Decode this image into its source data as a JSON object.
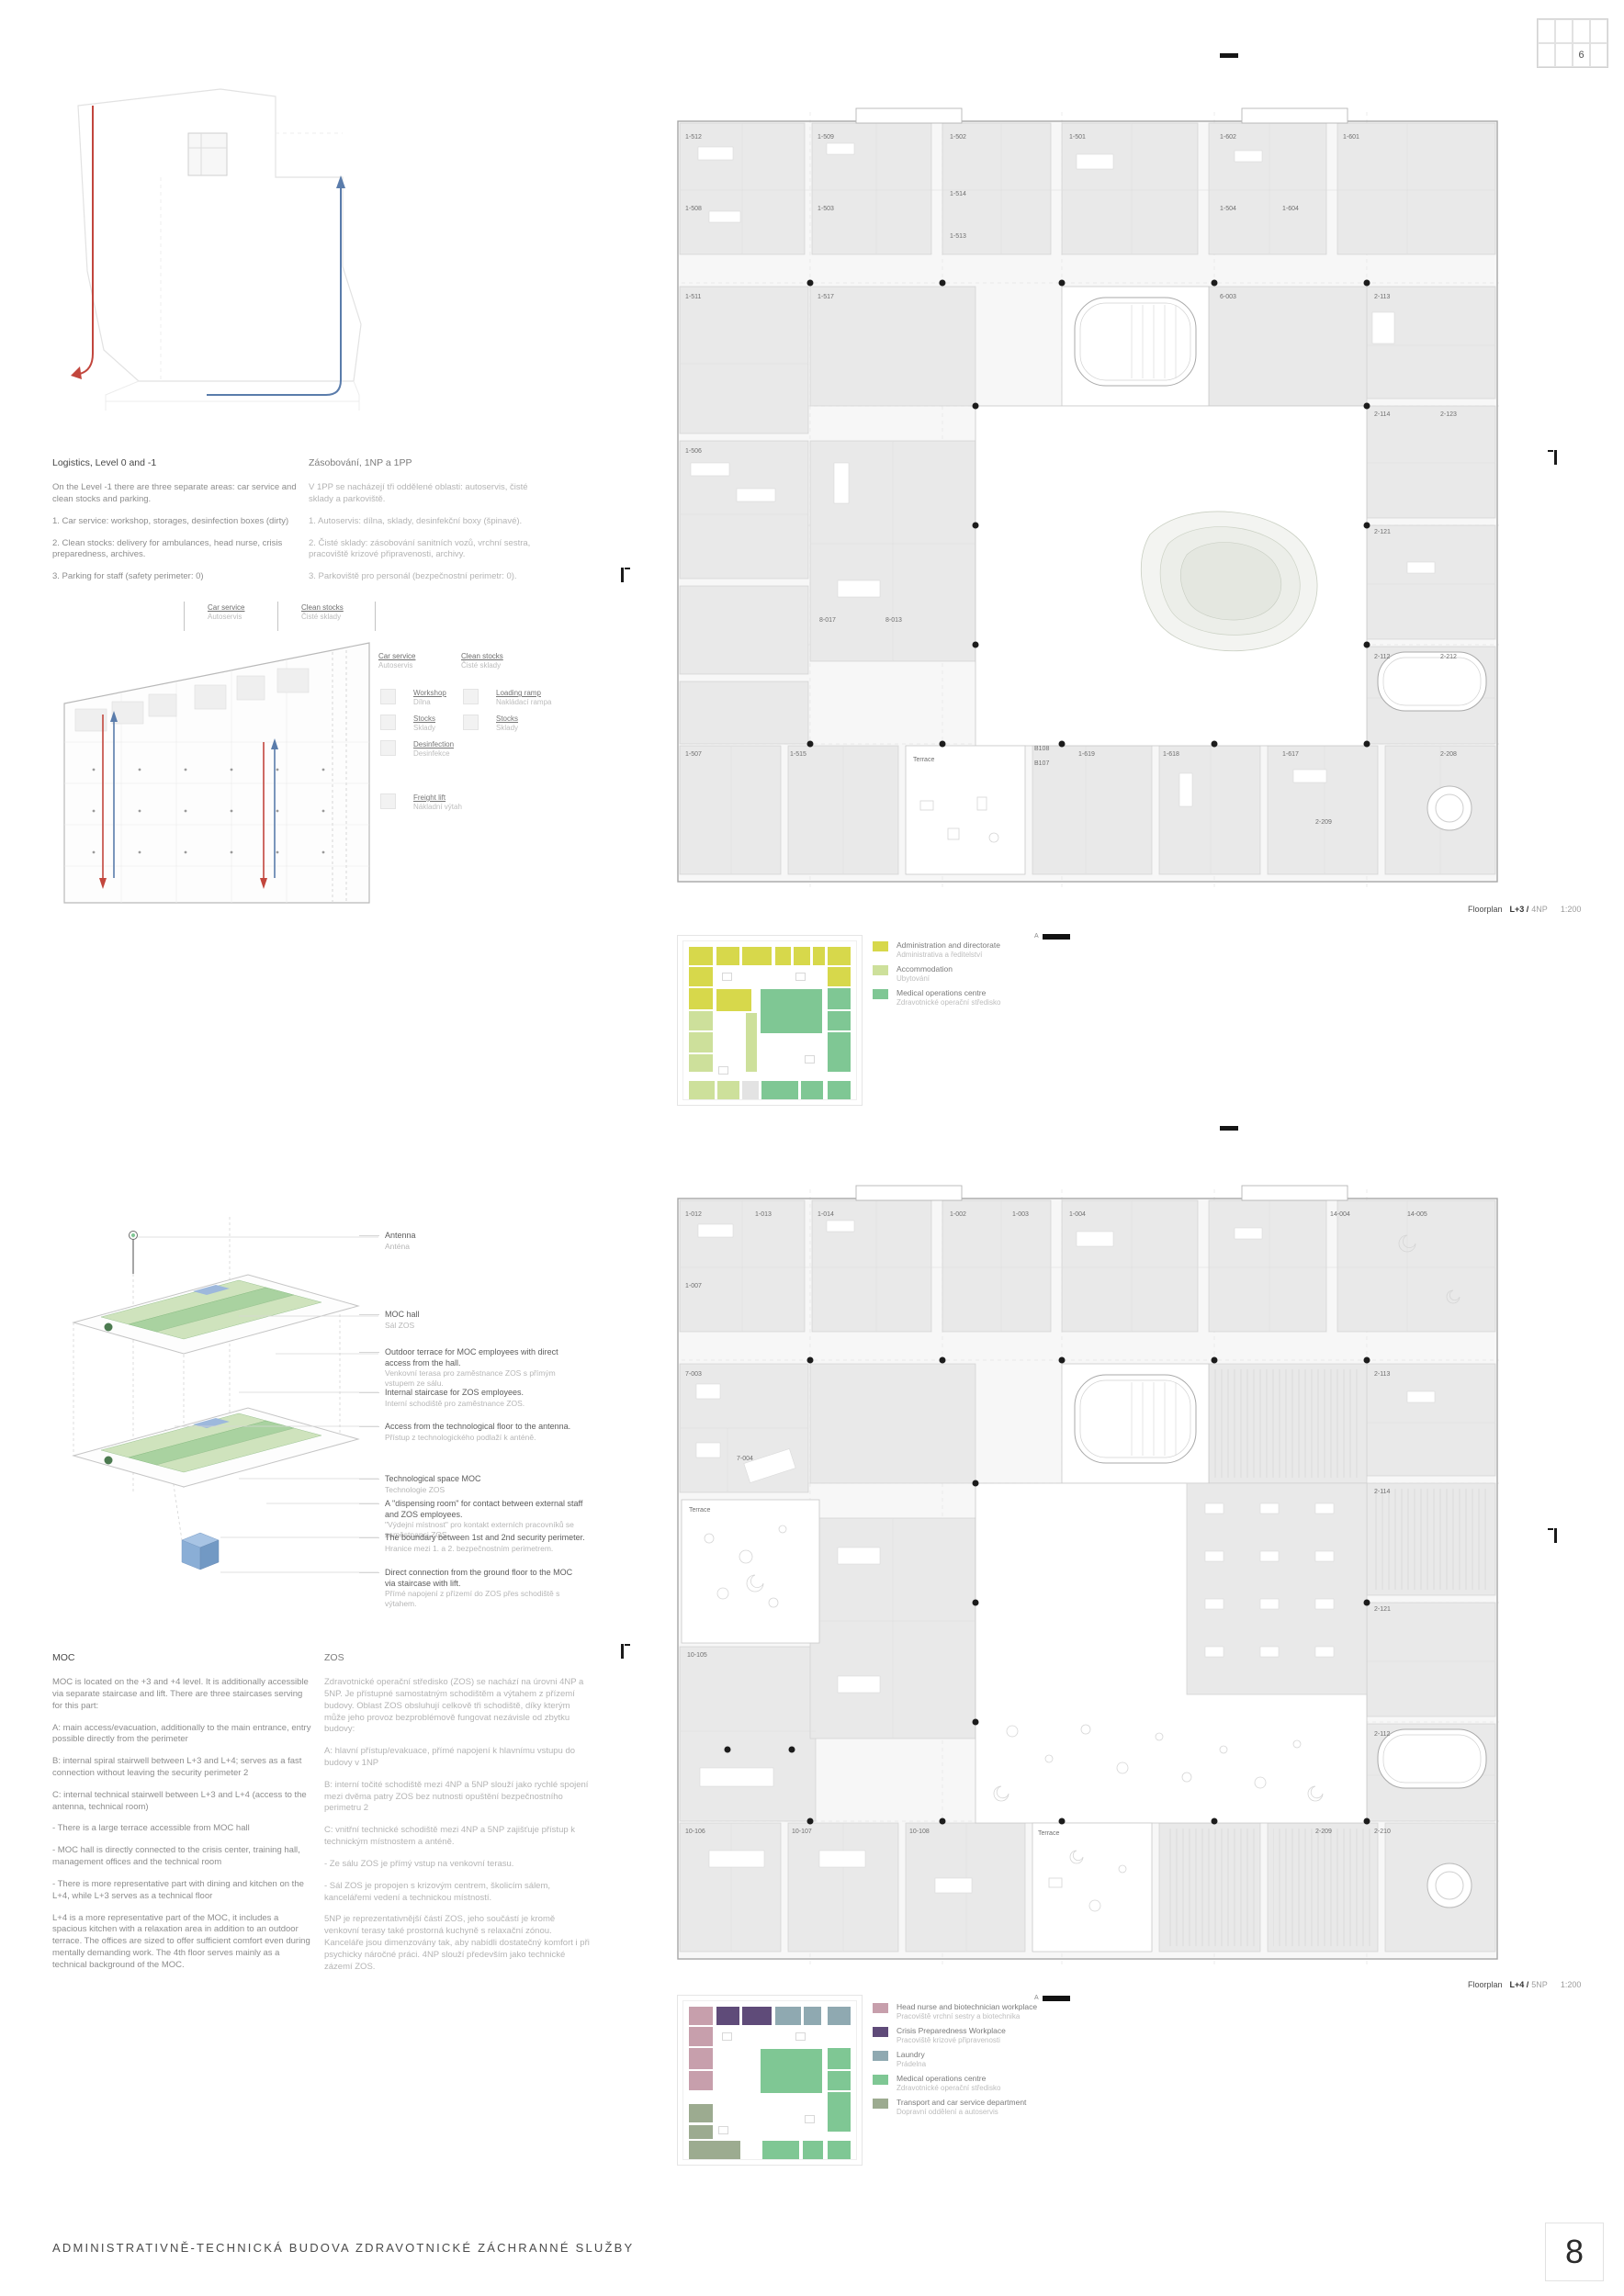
{
  "palette": {
    "Y": "#d7d84b",
    "LG": "#cde09b",
    "G": "#7fc794",
    "GY": "#e3e3e3",
    "M": "#c79fac",
    "P": "#5f4b79",
    "B": "#8fa9b1",
    "GG": "#9cab90"
  },
  "page": {
    "panel_no": "6",
    "page_no": "8",
    "footer_title": "ADMINISTRATIVNĚ-TECHNICKÁ BUDOVA ZDRAVOTNICKÉ ZÁCHRANNÉ SLUŽBY"
  },
  "logistics": {
    "en": {
      "title": "Logistics, Level 0 and -1",
      "paras": [
        "On the Level -1 there are three separate areas: car service and clean stocks and parking.",
        "1. Car service: workshop, storages, desinfection boxes (dirty)",
        "2. Clean stocks: delivery for ambulances, head nurse, crisis preparedness, archives.",
        "3. Parking for staff (safety perimeter: 0)"
      ]
    },
    "cs": {
      "title": "Zásobování, 1NP a 1PP",
      "paras": [
        "V 1PP se nacházejí tři oddělené oblasti: autoservis, čisté sklady a parkoviště.",
        "1. Autoservis: dílna, sklady, desinfekční boxy (špinavé).",
        "2. Čisté sklady: zásobování sanitních vozů, vrchní sestra, pracoviště krizové připravenosti, archivy.",
        "3. Parkoviště pro personál (bezpečnostní perimetr: 0)."
      ]
    }
  },
  "basement": {
    "zones": [
      {
        "en": "Car service",
        "cs": "Autoservis"
      },
      {
        "en": "Clean stocks",
        "cs": "Čisté sklady"
      }
    ],
    "legend": [
      {
        "en": "Workshop",
        "cs": "Dílna"
      },
      {
        "en": "Stocks",
        "cs": "Sklady"
      },
      {
        "en": "Desinfection",
        "cs": "Desinfekce"
      },
      {
        "en": "Freight lift",
        "cs": "Nákladní výtah"
      },
      {
        "en": "Loading ramp",
        "cs": "Nakládací rampa"
      },
      {
        "en": "Stocks",
        "cs": "Sklady"
      }
    ]
  },
  "floorplan1": {
    "caption": {
      "label": "Floorplan",
      "level": "L+3 /",
      "np": "4NP",
      "scale": "1:200"
    },
    "labels": [
      [
        "1-512",
        14,
        34
      ],
      [
        "1-509",
        158,
        34
      ],
      [
        "1-502",
        302,
        34
      ],
      [
        "1-501",
        432,
        34
      ],
      [
        "1-602",
        596,
        34
      ],
      [
        "1-601",
        730,
        34
      ],
      [
        "1-508",
        14,
        112
      ],
      [
        "1-503",
        158,
        112
      ],
      [
        "1-514",
        302,
        96
      ],
      [
        "1-513",
        302,
        142
      ],
      [
        "1-504",
        596,
        112
      ],
      [
        "1-604",
        664,
        112
      ],
      [
        "1-511",
        14,
        208
      ],
      [
        "1-517",
        158,
        208
      ],
      [
        "1-506",
        14,
        376
      ],
      [
        "6-003",
        596,
        208
      ],
      [
        "2-113",
        764,
        208
      ],
      [
        "2-114",
        764,
        336
      ],
      [
        "2-123",
        836,
        336
      ],
      [
        "2-121",
        764,
        464
      ],
      [
        "2-112",
        764,
        600
      ],
      [
        "2-212",
        836,
        600
      ],
      [
        "8-017",
        160,
        560
      ],
      [
        "8-013",
        232,
        560
      ],
      [
        "1-507",
        14,
        706
      ],
      [
        "1-515",
        128,
        706
      ],
      [
        "Terrace",
        262,
        712
      ],
      [
        "B108",
        394,
        700
      ],
      [
        "B107",
        394,
        716
      ],
      [
        "1-619",
        442,
        706
      ],
      [
        "1-618",
        534,
        706
      ],
      [
        "1-617",
        664,
        706
      ],
      [
        "2-209",
        700,
        780
      ],
      [
        "2-208",
        836,
        706
      ]
    ]
  },
  "keyplan1": {
    "marker": "A",
    "blocks": [
      [
        "Y",
        12,
        12,
        26,
        20
      ],
      [
        "Y",
        42,
        12,
        25,
        20
      ],
      [
        "Y",
        70,
        12,
        32,
        20
      ],
      [
        "Y",
        106,
        12,
        17,
        20
      ],
      [
        "Y",
        126,
        12,
        18,
        20
      ],
      [
        "Y",
        147,
        12,
        13,
        20
      ],
      [
        "Y",
        163,
        12,
        25,
        20
      ],
      [
        "Y",
        12,
        34,
        26,
        21
      ],
      [
        "Y",
        12,
        57,
        26,
        23
      ],
      [
        "LG",
        12,
        82,
        26,
        21
      ],
      [
        "LG",
        12,
        105,
        26,
        22
      ],
      [
        "LG",
        12,
        129,
        26,
        19
      ],
      [
        "LG",
        12,
        158,
        28,
        20
      ],
      [
        "LG",
        43,
        158,
        24,
        20
      ],
      [
        "GY",
        70,
        158,
        18,
        20
      ],
      [
        "G",
        91,
        158,
        40,
        20
      ],
      [
        "G",
        134,
        158,
        24,
        20
      ],
      [
        "G",
        163,
        158,
        25,
        20
      ],
      [
        "Y",
        163,
        34,
        25,
        21
      ],
      [
        "G",
        163,
        57,
        25,
        23
      ],
      [
        "G",
        163,
        82,
        25,
        21
      ],
      [
        "G",
        163,
        105,
        25,
        43
      ],
      [
        "Y",
        42,
        58,
        38,
        24
      ],
      [
        "LG",
        74,
        84,
        12,
        64
      ],
      [
        "G",
        90,
        58,
        67,
        48
      ]
    ],
    "legend": [
      {
        "en": "Administration and directorate",
        "cs": "Administrativa a ředitelství",
        "color": "#d7d84b"
      },
      {
        "en": "Accommodation",
        "cs": "Ubytování",
        "color": "#cde09b"
      },
      {
        "en": "Medical operations centre",
        "cs": "Zdravotnické operační středisko",
        "color": "#7fc794"
      }
    ]
  },
  "axon": {
    "annotations": [
      {
        "en": "Antenna",
        "cs": "Anténa"
      },
      {
        "en": "MOC hall",
        "cs": "Sál ZOS"
      },
      {
        "en": "Outdoor terrace for MOC employees with direct access from the hall.",
        "cs": "Venkovní terasa pro zaměstnance ZOS s přímým vstupem ze sálu."
      },
      {
        "en": "Internal staircase for ZOS employees.",
        "cs": "Interní schodiště pro zaměstnance ZOS."
      },
      {
        "en": "Access from the technological floor to the antenna.",
        "cs": "Přístup z technologického podlaží k anténě."
      },
      {
        "en": "Technological space MOC",
        "cs": "Technologie ZOS"
      },
      {
        "en": "A \"dispensing room\" for contact between external staff and ZOS employees.",
        "cs": "\"Výdejní místnost\" pro kontakt externích pracovníků se zaměstnanci ZOS."
      },
      {
        "en": "The boundary between 1st and 2nd security perimeter.",
        "cs": "Hranice mezi 1. a 2. bezpečnostním perimetrem."
      },
      {
        "en": "Direct connection from the ground floor to the MOC via staircase with lift.",
        "cs": "Přímé napojení z přízemí do ZOS přes schodiště s výtahem."
      }
    ]
  },
  "moc": {
    "title": "MOC",
    "paras": [
      "MOC is located on the +3 and +4 level. It is additionally accessible via separate staircase and lift. There are three staircases serving for this part:",
      "A: main access/evacuation, additionally to the main entrance, entry possible directly from the perimeter",
      "B: internal spiral stairwell between L+3 and L+4; serves as a fast connection without leaving the security perimeter 2",
      "C: internal technical stairwell between L+3 and L+4 (access to the antenna, technical room)",
      "- There is a large terrace accessible from MOC hall",
      "- MOC hall is directly connected to the crisis center, training hall, management offices and the technical room",
      "- There is more representative part with dining and kitchen on the L+4, while L+3 serves as a technical floor",
      "L+4 is a more representative part of the MOC, it includes a spacious kitchen with a relaxation area in addition to an outdoor terrace. The offices are sized to offer sufficient comfort even during mentally demanding work. The 4th floor serves mainly as a technical background of the MOC."
    ]
  },
  "zos": {
    "title": "ZOS",
    "paras": [
      "Zdravotnické operační středisko (ZOS) se nachází na úrovni 4NP a 5NP. Je přístupné samostatným schodištěm a výtahem z přízemí budovy. Oblast ZOS obsluhují celkově tři schodiště, díky kterým může jeho provoz bezproblémově fungovat nezávisle od zbytku budovy:",
      "A: hlavní přístup/evakuace, přímé napojení k hlavnímu vstupu do budovy v 1NP",
      "B: interní točité schodiště mezi 4NP a 5NP slouží jako rychlé spojení mezi dvěma patry ZOS bez nutnosti opuštění bezpečnostního perimetru 2",
      "C: vnitřní technické schodiště mezi 4NP a 5NP zajišťuje přístup k technickým místnostem a anténě.",
      "- Ze sálu ZOS je přímý vstup na venkovní terasu.",
      "- Sál ZOS je propojen s krizovým centrem, školicím sálem, kancelářemi vedení a technickou místností.",
      "5NP je reprezentativnější částí ZOS, jeho součástí je kromě venkovní terasy také prostorná kuchyně s relaxační zónou. Kanceláře jsou dimenzovány tak, aby nabídli dostatečný komfort i při psychicky náročné práci. 4NP slouží především jako technické zázemí ZOS."
    ]
  },
  "floorplan2": {
    "caption": {
      "label": "Floorplan",
      "level": "L+4 /",
      "np": "5NP",
      "scale": "1:200"
    },
    "labels": [
      [
        "1-012",
        14,
        34
      ],
      [
        "1-013",
        90,
        34
      ],
      [
        "1-014",
        158,
        34
      ],
      [
        "1-002",
        302,
        34
      ],
      [
        "1-003",
        370,
        34
      ],
      [
        "1-004",
        432,
        34
      ],
      [
        "14-004",
        716,
        34
      ],
      [
        "14-005",
        800,
        34
      ],
      [
        "1-007",
        14,
        112
      ],
      [
        "7-003",
        14,
        208
      ],
      [
        "7-004",
        70,
        300
      ],
      [
        "Terrace",
        18,
        356
      ],
      [
        "10-105",
        16,
        514
      ],
      [
        "2-113",
        764,
        208
      ],
      [
        "2-114",
        764,
        336
      ],
      [
        "2-121",
        764,
        464
      ],
      [
        "2-112",
        764,
        600
      ],
      [
        "10-106",
        14,
        706
      ],
      [
        "10-107",
        130,
        706
      ],
      [
        "10-108",
        258,
        706
      ],
      [
        "Terrace",
        398,
        708
      ],
      [
        "2-209",
        700,
        706
      ],
      [
        "2-210",
        764,
        706
      ]
    ]
  },
  "keyplan2": {
    "marker": "A",
    "blocks": [
      [
        "M",
        12,
        12,
        26,
        20
      ],
      [
        "P",
        42,
        12,
        25,
        20
      ],
      [
        "P",
        70,
        12,
        32,
        20
      ],
      [
        "B",
        106,
        12,
        28,
        20
      ],
      [
        "B",
        137,
        12,
        19,
        20
      ],
      [
        "B",
        163,
        12,
        25,
        20
      ],
      [
        "M",
        12,
        34,
        26,
        21
      ],
      [
        "M",
        12,
        57,
        26,
        23
      ],
      [
        "M",
        12,
        82,
        26,
        21
      ],
      [
        "GG",
        12,
        118,
        26,
        20
      ],
      [
        "GG",
        12,
        141,
        26,
        15
      ],
      [
        "GG",
        12,
        158,
        56,
        20
      ],
      [
        "G",
        92,
        158,
        40,
        20
      ],
      [
        "G",
        136,
        158,
        22,
        20
      ],
      [
        "G",
        163,
        158,
        25,
        20
      ],
      [
        "G",
        163,
        57,
        25,
        23
      ],
      [
        "G",
        163,
        82,
        25,
        21
      ],
      [
        "G",
        163,
        105,
        25,
        43
      ],
      [
        "G",
        90,
        58,
        67,
        48
      ]
    ],
    "legend": [
      {
        "en": "Head nurse and biotechnician workplace",
        "cs": "Pracoviště vrchní sestry a biotechnika",
        "color": "#c79fac"
      },
      {
        "en": "Crisis Preparedness Workplace",
        "cs": "Pracoviště krizové připravenosti",
        "color": "#5f4b79"
      },
      {
        "en": "Laundry",
        "cs": "Prádelna",
        "color": "#8fa9b1"
      },
      {
        "en": "Medical operations centre",
        "cs": "Zdravotnické operační středisko",
        "color": "#7fc794"
      },
      {
        "en": "Transport and car service department",
        "cs": "Dopravní oddělení a autoservis",
        "color": "#9cab90"
      }
    ]
  }
}
